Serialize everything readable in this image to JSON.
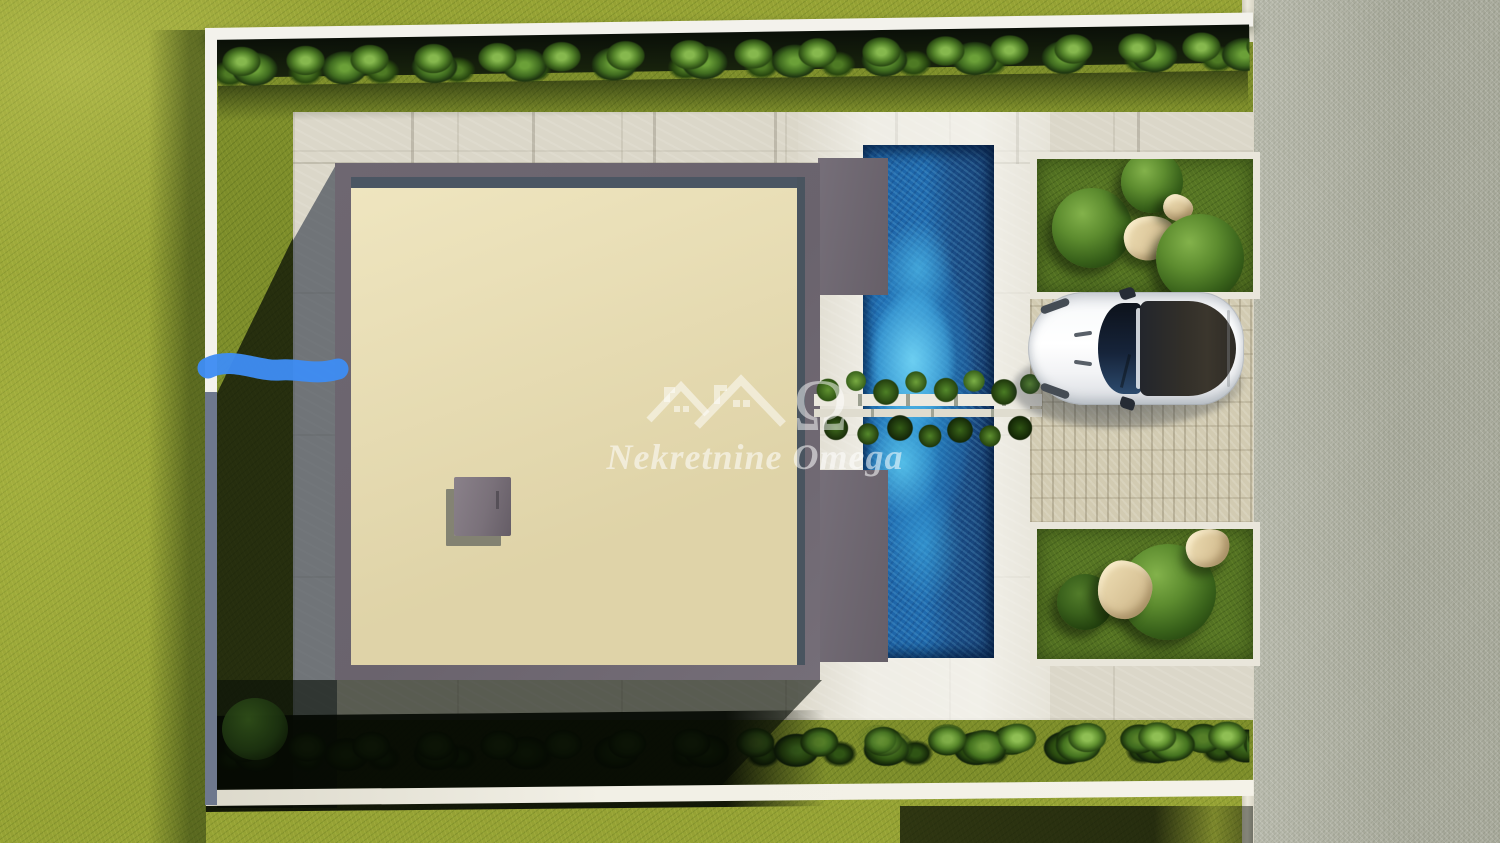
{
  "scene": {
    "type": "aerial-3d-render",
    "description": "Top-down 3D architectural rendering of a modern villa plot: flat-roof house with roof hatch, blue swimming pool crossed by a planter bridge, stone patio, two gravel garden beds with bushes and rocks, paver driveway with a parked white sports car, white perimeter wall with hedge rows, surrounding lawn and a gravel road on the right.",
    "annotation_note": "hand-drawn blue marker stroke over the left boundary wall"
  },
  "watermark": {
    "title": "Nekretnine Omega",
    "omega_symbol": "Ω",
    "logo": "two-house-roofs-with-omega"
  },
  "objects": {
    "lawn": "grass lawn",
    "road": "gravel road",
    "curb": "road curb strip",
    "wall": "white perimeter wall",
    "hedge_top": "hedge row along top wall",
    "hedge_bottom": "hedge row along bottom wall",
    "patio": "stone slab patio",
    "driveway": "paver driveway",
    "house": "flat-roof villa with beige roof deck",
    "roof_hatch": "roof access hatch",
    "pool": "swimming pool",
    "planter": "planter bridge over pool",
    "bed_top": "garden bed with three bushes and rocks",
    "bed_bottom": "garden bed with two bushes and rocks",
    "car": "white sports car, top view, facing left",
    "marker": "blue marker annotation stroke"
  },
  "palette": {
    "lawn": "#95a134",
    "lawn_shadow": "#10180a",
    "road": "#b2b4a5",
    "wall": "#f3f2ec",
    "patio": "#dbd7c9",
    "patio_shadow": "#5f6b80",
    "roof_deck": "#e6daad",
    "house_frame": "#6e6771",
    "pool_deep": "#173f72",
    "pool_bright": "#2e9fd8",
    "driveway": "#d2cbb2",
    "bed_grass": "#567524",
    "hedge": "#4e7a24",
    "rock": "#e3cfa4",
    "car_body": "#f5f6f8",
    "marker_blue": "#3e8cf2"
  }
}
